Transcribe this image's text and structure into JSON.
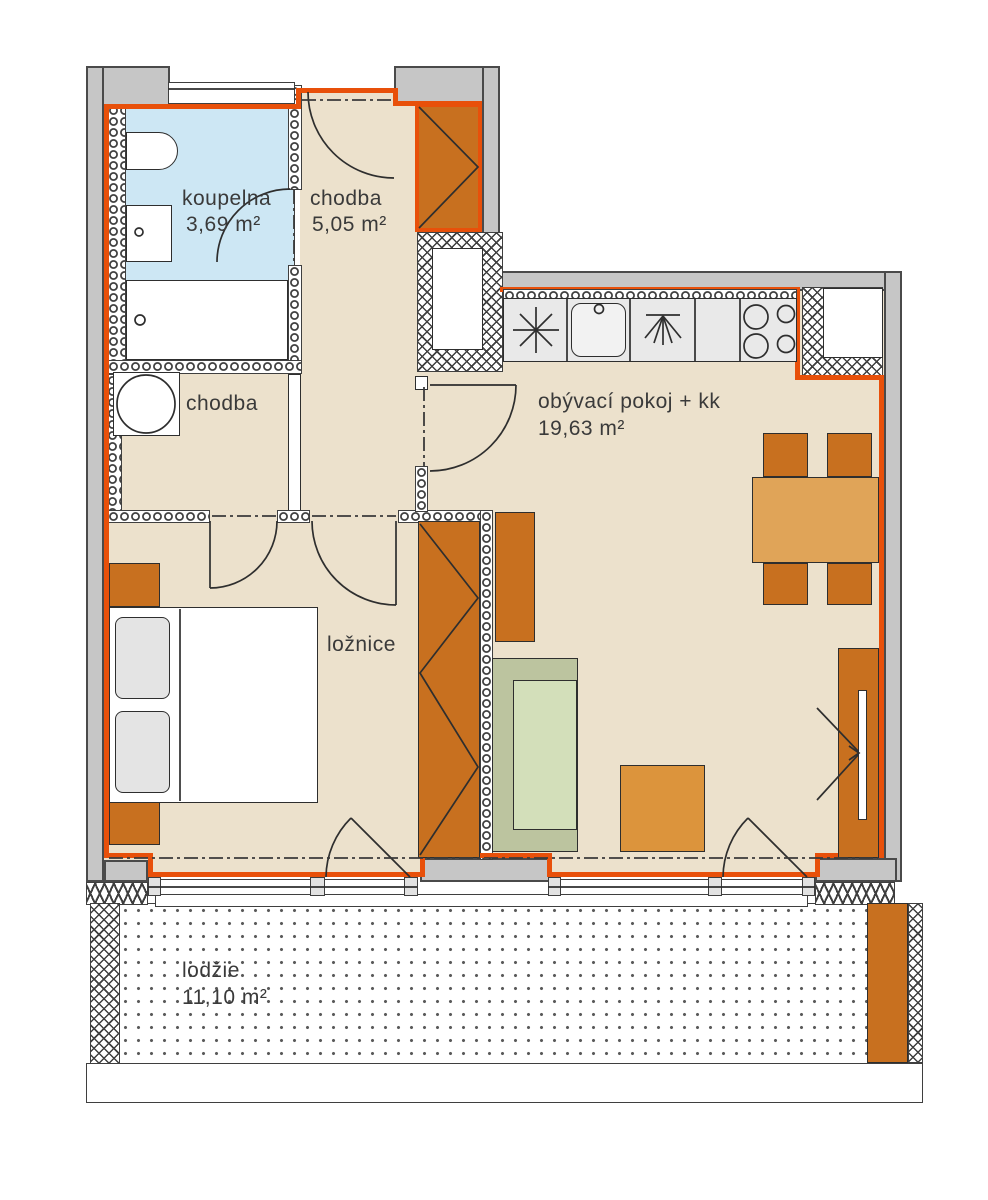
{
  "plan": {
    "rooms": [
      {
        "name": "koupelna",
        "area": "3,69 m²"
      },
      {
        "name": "chodba",
        "area": "5,05 m²"
      },
      {
        "name": "chodba",
        "area": ""
      },
      {
        "name": "obývací pokoj + kk",
        "area": "19,63 m²"
      },
      {
        "name": "ložnice",
        "area": ""
      },
      {
        "name": "lodžie",
        "area": "11,10 m²"
      }
    ],
    "colors": {
      "apartment_outline": "#e8500a",
      "exterior_wall": "#c6c6c6",
      "floor_beige": "#ece1cc",
      "bathroom_floor": "#cde7f4",
      "furniture_dark_orange": "#c8701f",
      "dining_table_orange": "#e0a458",
      "coffee_table_orange": "#dc943c",
      "sofa_green": "#bcc49f",
      "sofa_seat_green": "#d3dfba",
      "wall_line": "#3f3f3f"
    }
  }
}
